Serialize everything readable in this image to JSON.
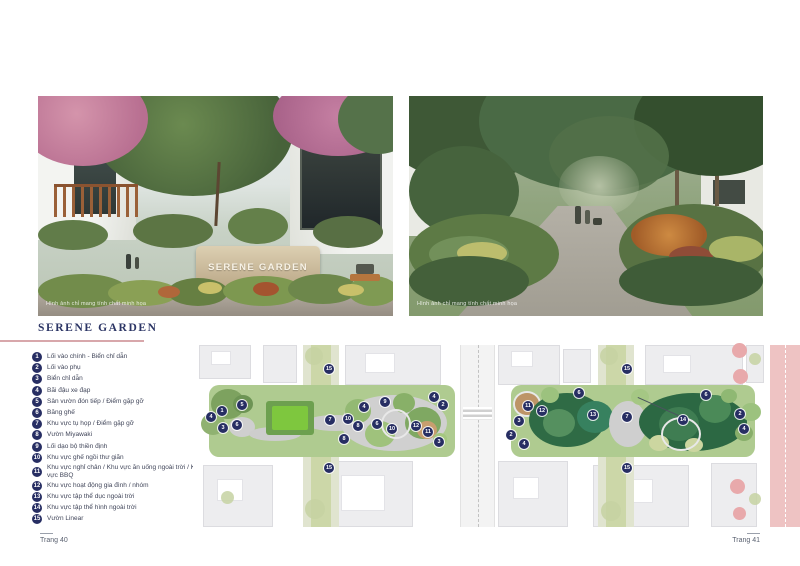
{
  "page": {
    "footer_left": "Trang 40",
    "footer_right": "Trang 41"
  },
  "section_title": "SERENE GARDEN",
  "photos": {
    "left": {
      "caption": "Hình ảnh chỉ mang tính chất minh họa",
      "sign_text": "SERENE GARDEN"
    },
    "right": {
      "caption": "Hình ảnh chỉ mang tính chất minh họa"
    }
  },
  "legend": [
    {
      "num": "1",
      "label": "Lối vào chính - Biển chỉ dẫn"
    },
    {
      "num": "2",
      "label": "Lối vào phụ"
    },
    {
      "num": "3",
      "label": "Biển chỉ dẫn"
    },
    {
      "num": "4",
      "label": "Bãi đậu xe đạp"
    },
    {
      "num": "5",
      "label": "Sân vườn đón tiếp / Điểm gặp gỡ"
    },
    {
      "num": "6",
      "label": "Băng ghế"
    },
    {
      "num": "7",
      "label": "Khu vực tụ họp / Điểm gặp gỡ"
    },
    {
      "num": "8",
      "label": "Vườn Miyawaki"
    },
    {
      "num": "9",
      "label": "Lối dạo bộ thiền định"
    },
    {
      "num": "10",
      "label": "Khu vực ghế ngồi thư giãn"
    },
    {
      "num": "11",
      "label": "Khu vực nghỉ chân / Khu vực ăn uống ngoài trời / Khu vực BBQ"
    },
    {
      "num": "12",
      "label": "Khu vực hoạt động gia đình / nhóm"
    },
    {
      "num": "13",
      "label": "Khu vực tập thể dục ngoài trời"
    },
    {
      "num": "14",
      "label": "Khu vực tập thể hình ngoài trời"
    },
    {
      "num": "15",
      "label": "Vườn Linear"
    }
  ],
  "siteplan": {
    "markers": [
      {
        "num": "15",
        "x": 136,
        "y": 24
      },
      {
        "num": "5",
        "x": 49,
        "y": 60
      },
      {
        "num": "1",
        "x": 29,
        "y": 66
      },
      {
        "num": "4",
        "x": 18,
        "y": 72
      },
      {
        "num": "6",
        "x": 44,
        "y": 80
      },
      {
        "num": "3",
        "x": 30,
        "y": 83
      },
      {
        "num": "7",
        "x": 137,
        "y": 75
      },
      {
        "num": "10",
        "x": 155,
        "y": 74
      },
      {
        "num": "4",
        "x": 171,
        "y": 62
      },
      {
        "num": "9",
        "x": 192,
        "y": 57
      },
      {
        "num": "8",
        "x": 165,
        "y": 81
      },
      {
        "num": "6",
        "x": 184,
        "y": 79
      },
      {
        "num": "10",
        "x": 199,
        "y": 84
      },
      {
        "num": "8",
        "x": 151,
        "y": 94
      },
      {
        "num": "12",
        "x": 223,
        "y": 81
      },
      {
        "num": "11",
        "x": 235,
        "y": 87
      },
      {
        "num": "3",
        "x": 246,
        "y": 97
      },
      {
        "num": "2",
        "x": 250,
        "y": 60
      },
      {
        "num": "4",
        "x": 241,
        "y": 52
      },
      {
        "num": "15",
        "x": 136,
        "y": 123
      },
      {
        "num": "15",
        "x": 434,
        "y": 24
      },
      {
        "num": "11",
        "x": 335,
        "y": 61
      },
      {
        "num": "12",
        "x": 349,
        "y": 66
      },
      {
        "num": "6",
        "x": 386,
        "y": 48
      },
      {
        "num": "13",
        "x": 400,
        "y": 70
      },
      {
        "num": "3",
        "x": 326,
        "y": 76
      },
      {
        "num": "2",
        "x": 318,
        "y": 90
      },
      {
        "num": "4",
        "x": 331,
        "y": 99
      },
      {
        "num": "7",
        "x": 434,
        "y": 72
      },
      {
        "num": "14",
        "x": 490,
        "y": 75
      },
      {
        "num": "6",
        "x": 513,
        "y": 50
      },
      {
        "num": "2",
        "x": 547,
        "y": 69
      },
      {
        "num": "4",
        "x": 551,
        "y": 84
      },
      {
        "num": "15",
        "x": 434,
        "y": 123
      }
    ]
  },
  "colors": {
    "navy": "#272e63",
    "accent_line": "#d8a7ab",
    "plan_pink": "#eec3c3",
    "lawn_green": "#7ec73e"
  }
}
